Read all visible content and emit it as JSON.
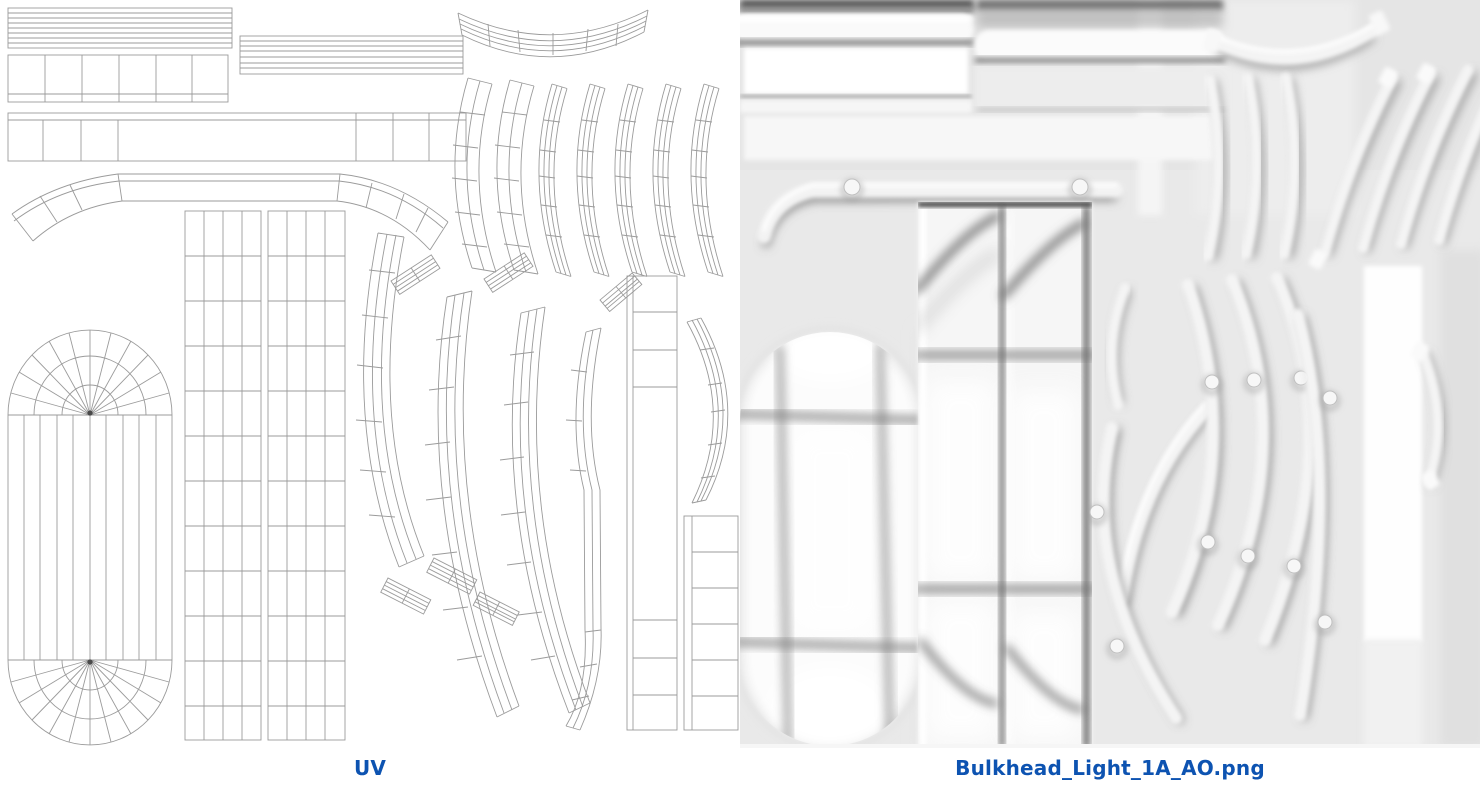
{
  "page": {
    "background_color": "#ffffff"
  },
  "figure": {
    "left_panel": {
      "label": "UV",
      "content": "uv-wireframe-layout",
      "background_color": "#ffffff",
      "line_color": "#9b9b9b"
    },
    "right_panel": {
      "label": "Bulkhead_Light_1A_AO.png",
      "content": "ambient-occlusion-texture-bake",
      "background_color": "#e9e9e9"
    },
    "caption_color": "#0d53b1"
  }
}
